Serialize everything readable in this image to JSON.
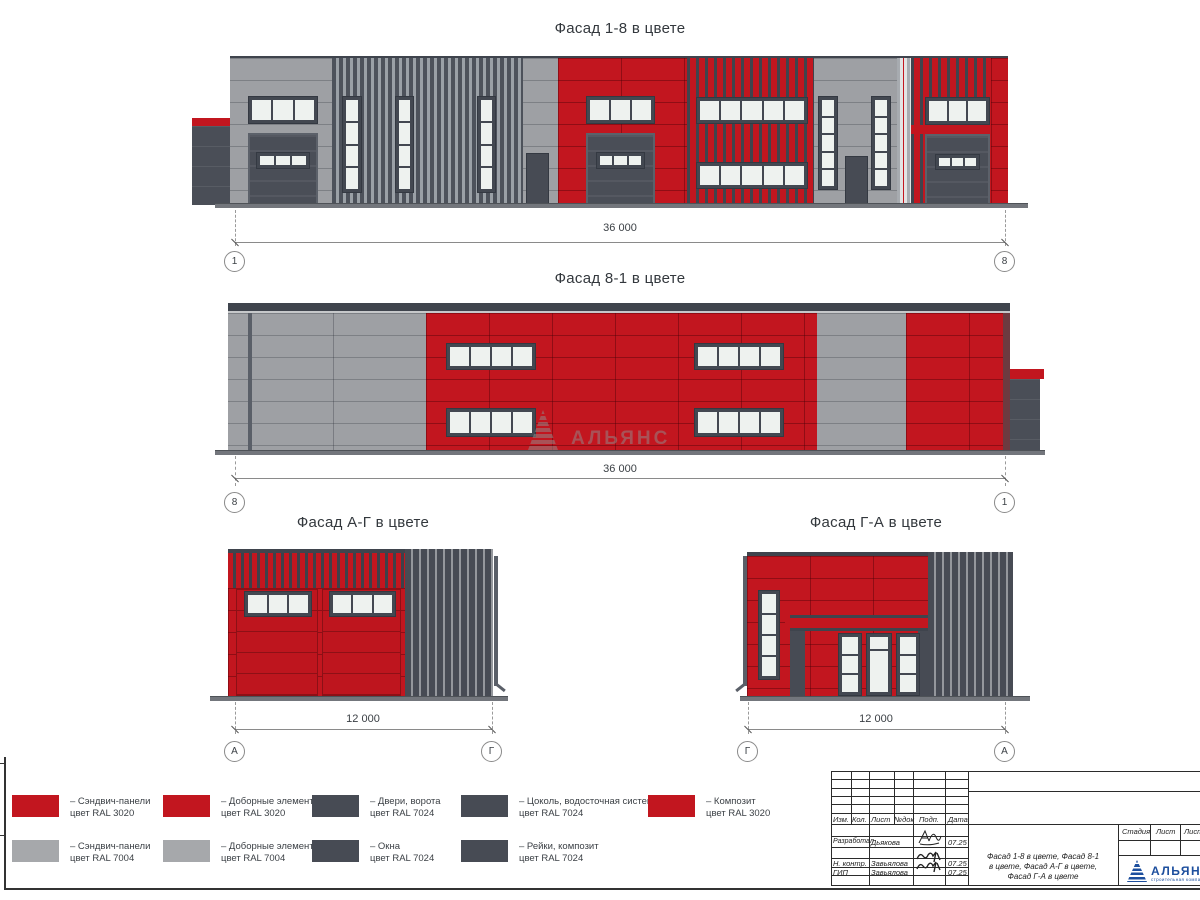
{
  "colors": {
    "ral3020_red": "#C2161F",
    "ral7004_gray": "#9EA0A4",
    "ral7024_dark": "#474B54",
    "window_pane": "#EEF2EF",
    "logo_blue": "#1D4F9E"
  },
  "facades": {
    "f18": {
      "title": "Фасад 1-8 в цвете",
      "dim": "36 000",
      "axis_left": "1",
      "axis_right": "8"
    },
    "f81": {
      "title": "Фасад 8-1 в цвете",
      "dim": "36 000",
      "axis_left": "8",
      "axis_right": "1"
    },
    "fag": {
      "title": "Фасад А-Г в цвете",
      "dim": "12 000",
      "axis_left": "А",
      "axis_right": "Г"
    },
    "fga": {
      "title": "Фасад Г-А в цвете",
      "dim": "12 000",
      "axis_left": "Г",
      "axis_right": "А"
    }
  },
  "legend": {
    "items": [
      {
        "line1": "– Сэндвич-панели",
        "line2": "цвет RAL 3020",
        "swatch": "red"
      },
      {
        "line1": "– Сэндвич-панели",
        "line2": "цвет RAL 7004",
        "swatch": "gray"
      },
      {
        "line1": "– Доборные элементы",
        "line2": "цвет RAL 3020",
        "swatch": "red"
      },
      {
        "line1": "– Доборные элементы",
        "line2": "цвет RAL 7004",
        "swatch": "gray"
      },
      {
        "line1": "– Двери, ворота",
        "line2": "цвет RAL 7024",
        "swatch": "dark"
      },
      {
        "line1": "– Окна",
        "line2": "цвет RAL 7024",
        "swatch": "dark"
      },
      {
        "line1": "– Цоколь, водосточная система",
        "line2": "цвет RAL 7024",
        "swatch": "dark"
      },
      {
        "line1": "– Рейки, композит",
        "line2": "цвет RAL 7024",
        "swatch": "dark"
      },
      {
        "line1": "– Композит",
        "line2": "цвет RAL 3020",
        "swatch": "red"
      }
    ]
  },
  "stamp": {
    "header": {
      "izm": "Изм.",
      "kol": "Кол.",
      "list": "Лист",
      "ndok": "№док",
      "podp": "Подп.",
      "data": "Дата"
    },
    "rows": [
      {
        "role": "Разработал",
        "name": "Дьякова",
        "date": "07.25"
      },
      {
        "role": "Н. контр.",
        "name": "Завьялова",
        "date": "07.25"
      },
      {
        "role": "ГИП",
        "name": "Завьялова",
        "date": "07.25"
      }
    ],
    "doc_title_l1": "Фасад 1-8 в цвете, Фасад 8-1",
    "doc_title_l2": "в цвете, Фасад А-Г в цвете,",
    "doc_title_l3": "Фасад Г-А в цвете",
    "stage_header": {
      "stage": "Стадия",
      "sheet": "Лист",
      "sheets": "Листов"
    },
    "logo": {
      "brand": "АЛЬЯНС",
      "subtitle": "строительная компания"
    }
  },
  "watermark": {
    "brand": "АЛЬЯНС"
  }
}
